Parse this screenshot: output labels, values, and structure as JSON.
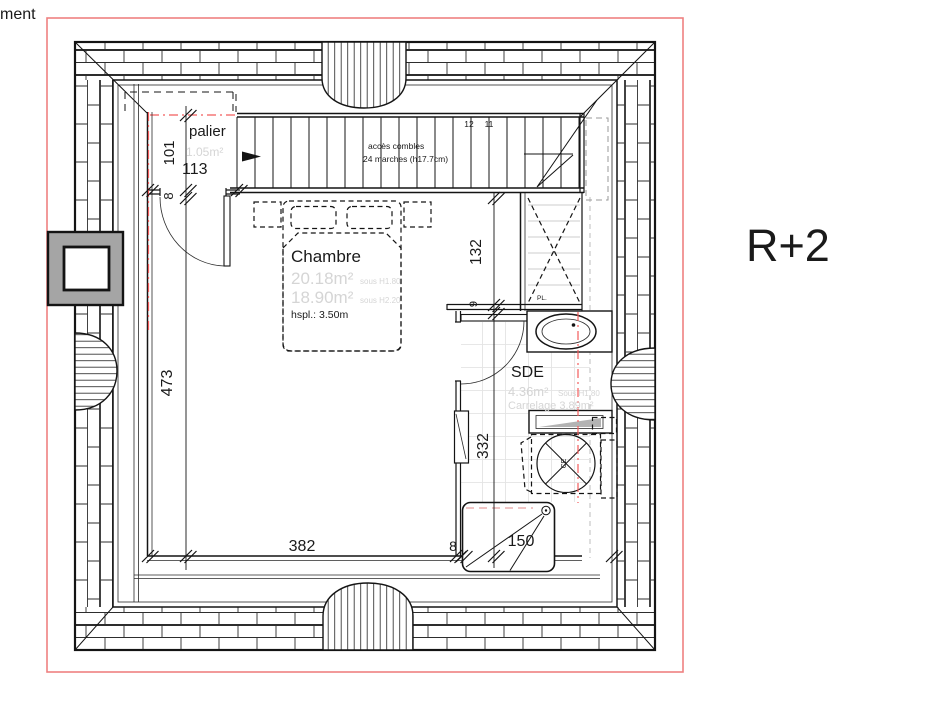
{
  "title_fragment": "ment",
  "floor_label": "R+2",
  "colors": {
    "frame_red": "#ee8181",
    "axis_red": "#f25c5c",
    "faint_text_gray": "#d5d5d5",
    "wall_black": "#141414",
    "chimney_gray": "#a5a5a5",
    "radiator_gray": "#b3b3b3",
    "shelf_gray": "#cdcdcd",
    "tile_gray": "#e4e4e4"
  },
  "rooms": {
    "palier": {
      "name": "palier",
      "area": "1.05m²"
    },
    "chambre": {
      "name": "Chambre",
      "area_under_h180": "20.18m²",
      "note_h180": "sous H1.80",
      "area_under_h220": "18.90m²",
      "note_h220": "sous H2.20",
      "ceiling_height": "hspl.: 3.50m"
    },
    "sde": {
      "name": "SDE",
      "area": "4.36m²",
      "area_note": "Sous H1.80",
      "tiling": "Carrelage 3.89m²"
    },
    "placard": {
      "label": "PL."
    }
  },
  "stairs": {
    "access_label": "accès combles",
    "steps_label": "24 marches (h17.7cm)",
    "step_numbers": [
      "12",
      "11"
    ]
  },
  "equipment": {
    "water_heater": "CE"
  },
  "dimensions": {
    "palier_depth": "101",
    "palier_width": "113",
    "wall_left": "8",
    "chambre_height": "473",
    "closet_depth": "132",
    "wall_mid": "9",
    "sde_depth": "332",
    "chambre_width": "382",
    "wall_bottom": "8",
    "sde_width": "150"
  }
}
